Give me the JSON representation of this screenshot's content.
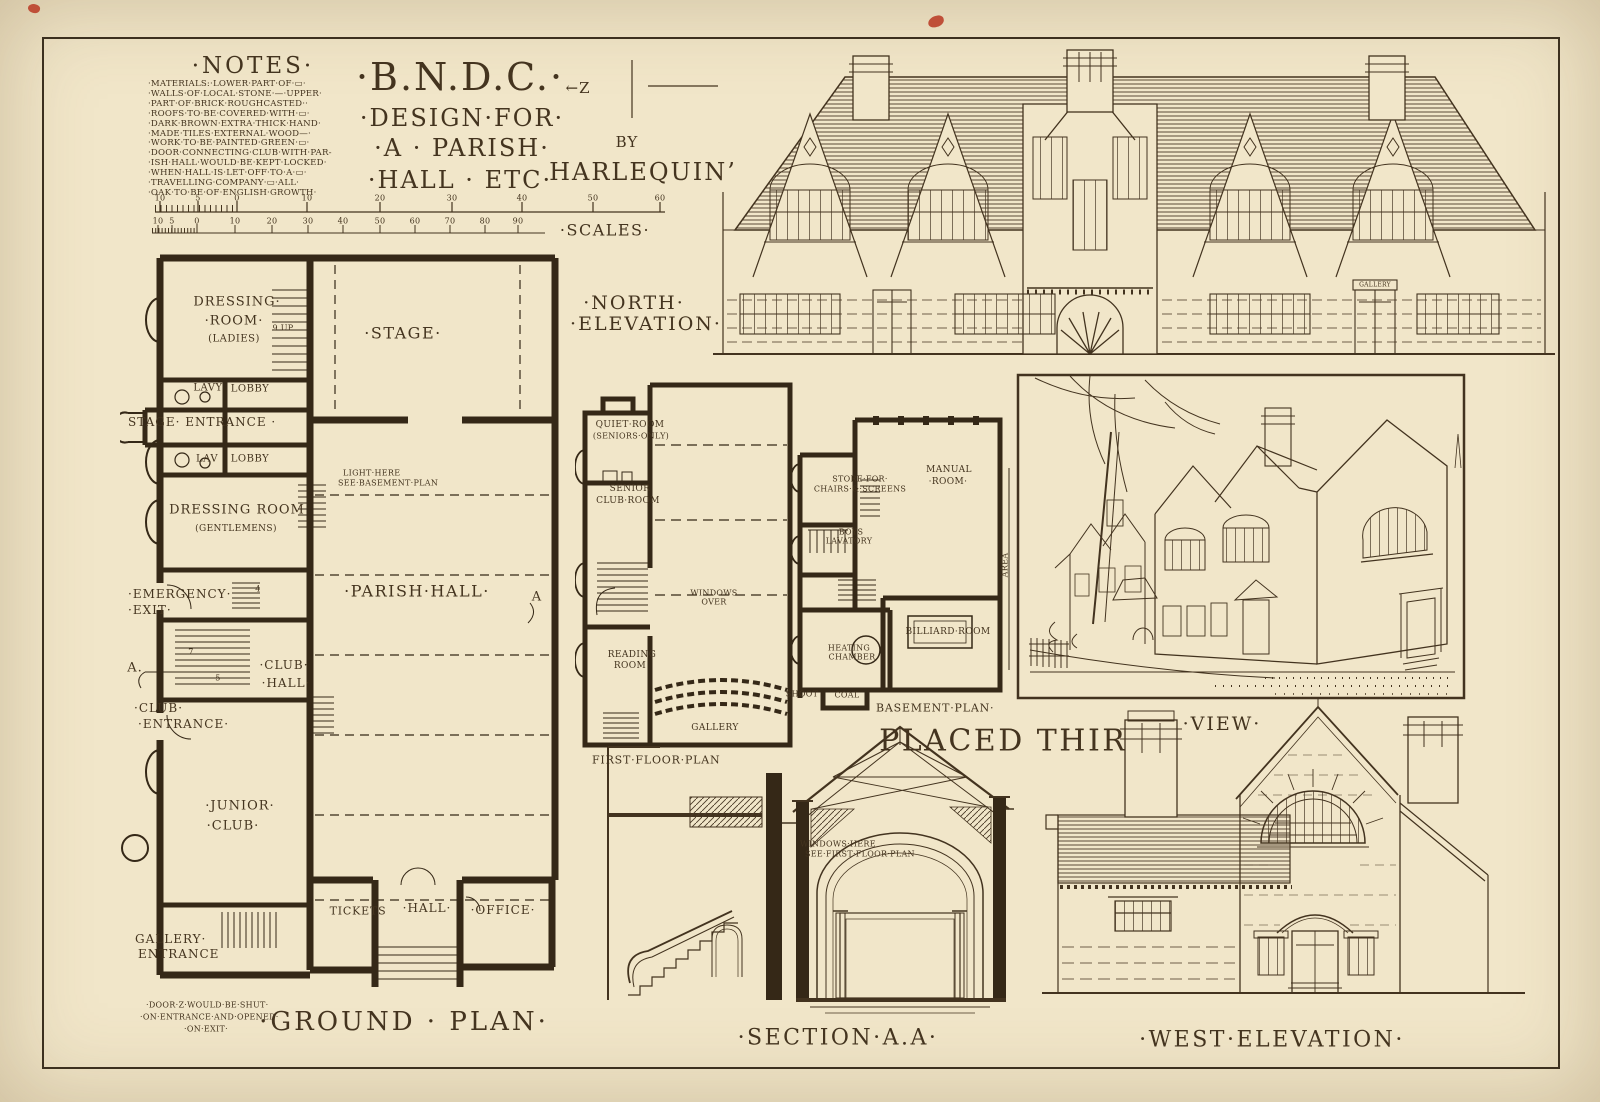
{
  "sheet": {
    "paper_color": "#f1e6c9",
    "ink_color": "#44341f",
    "wall_color": "#352817",
    "accent_speck_color": "#bf4f38"
  },
  "title_block": {
    "line1": "·B.N.D.C.·",
    "line2": "·DESIGN·FOR·",
    "line3": "·A · PARISH·",
    "line4": "·HALL · ETC·",
    "by_label": "BY",
    "author": "HARLEQUIN’",
    "z_mark": "←Z"
  },
  "notes": {
    "heading": "·NOTES·",
    "lines": [
      "·MATERIALS:·LOWER·PART·OF·▭·",
      "·WALLS·OF·LOCAL·STONE·—·UPPER·",
      "·PART·OF·BRICK·ROUGHCASTED··",
      "·ROOFS·TO·BE·COVERED·WITH·▭·",
      "·DARK·BROWN·EXTRA·THICK·HAND·",
      "·MADE·TILES·EXTERNAL·WOOD—·",
      "·WORK·TO·BE·PAINTED·GREEN·▭·",
      "·DOOR·CONNECTING·CLUB·WITH·PAR-",
      "·ISH·HALL·WOULD·BE·KEPT·LOCKED·",
      "·WHEN·HALL·IS·LET·OFF·TO·A·▭·",
      "·TRAVELLING·COMPANY·▭·ALL·",
      "·OAK·TO·BE·OF·ENGLISH·GROWTH·"
    ]
  },
  "scales": {
    "label": "·SCALES·",
    "top_ticks": [
      "10",
      "5",
      "0",
      "10",
      "20",
      "30",
      "40",
      "50",
      "60"
    ],
    "bottom_ticks": [
      "10",
      "5",
      "0",
      "10",
      "20",
      "30",
      "40",
      "50",
      "60",
      "70",
      "80",
      "90"
    ]
  },
  "ground_plan": {
    "caption": "·GROUND · PLAN·",
    "labels": {
      "dressing_ladies": [
        "DRESSING·",
        "·ROOM·",
        "(LADIES)"
      ],
      "stair_up": "9 UP",
      "stage": "·STAGE·",
      "lavy": "LAVY",
      "lobby1": "LOBBY",
      "stage_entrance": "STAGE· ENTRANCE ·",
      "lav": "LAV",
      "lobby2": "LOBBY",
      "dressing_gents": [
        "DRESSING ROOM",
        "(GENTLEMENS)"
      ],
      "light_note": [
        "LIGHT·HERE",
        "SEE·BASEMENT·PLAN"
      ],
      "emergency": [
        "·EMERGENCY·",
        "·EXIT·"
      ],
      "parish_hall": "·PARISH·HALL·",
      "club_hall": [
        "·CLUB·",
        "·HALL·"
      ],
      "club_entrance": [
        "·CLUB·",
        "·ENTRANCE·"
      ],
      "junior_club": [
        "·JUNIOR·",
        "·CLUB·"
      ],
      "gallery_entrance": [
        "GALLERY·",
        "ENTRANCE"
      ],
      "tickets": "TICKETS",
      "hall": "·HALL·",
      "office": "·OFFICE·",
      "marker_a_left": "A.",
      "marker_a_right": "A",
      "num_7": "7",
      "num_5": "5",
      "num_4": "4",
      "door_note": [
        "·DOOR·Z·WOULD·BE·SHUT·",
        "·ON·ENTRANCE·AND·OPENED·",
        "·ON·EXIT·"
      ]
    }
  },
  "first_floor_plan": {
    "caption": "FIRST·FLOOR·PLAN",
    "labels": {
      "quiet_room": [
        "QUIET·ROOM",
        "(SENIORS·ONLY)"
      ],
      "senior_club": [
        "SENIOR",
        "CLUB·ROOM"
      ],
      "windows_over": [
        "WINDOWS",
        "OVER"
      ],
      "reading_room": [
        "READING",
        "ROOM"
      ],
      "gallery": "GALLERY"
    }
  },
  "basement_plan": {
    "caption": "BASEMENT·PLAN·",
    "labels": {
      "store": [
        "STORE·FOR·",
        "CHAIRS·&·SCREENS"
      ],
      "manual_room": [
        "MANUAL",
        "·ROOM·"
      ],
      "boys_lavatory": [
        "BOYS",
        "LAVATORY"
      ],
      "heating_chamber": [
        "HEATING",
        "CHAMBER"
      ],
      "billiard_room": "BILLIARD·ROOM",
      "shoot": "SHOOT",
      "coal": "COAL",
      "area": "AREA"
    }
  },
  "north_elevation": {
    "label_line1": "·NORTH·",
    "label_line2": "·ELEVATION·",
    "gallery_sign": "GALLERY"
  },
  "view": {
    "label": "·VIEW·"
  },
  "award": {
    "text": "PLACED THIRD."
  },
  "section": {
    "caption": "·SECTION·A.A·",
    "note": [
      "WINDOWS·HERE",
      "SEE·FIRST·FLOOR·PLAN"
    ]
  },
  "west_elevation": {
    "caption": "·WEST·ELEVATION·"
  }
}
